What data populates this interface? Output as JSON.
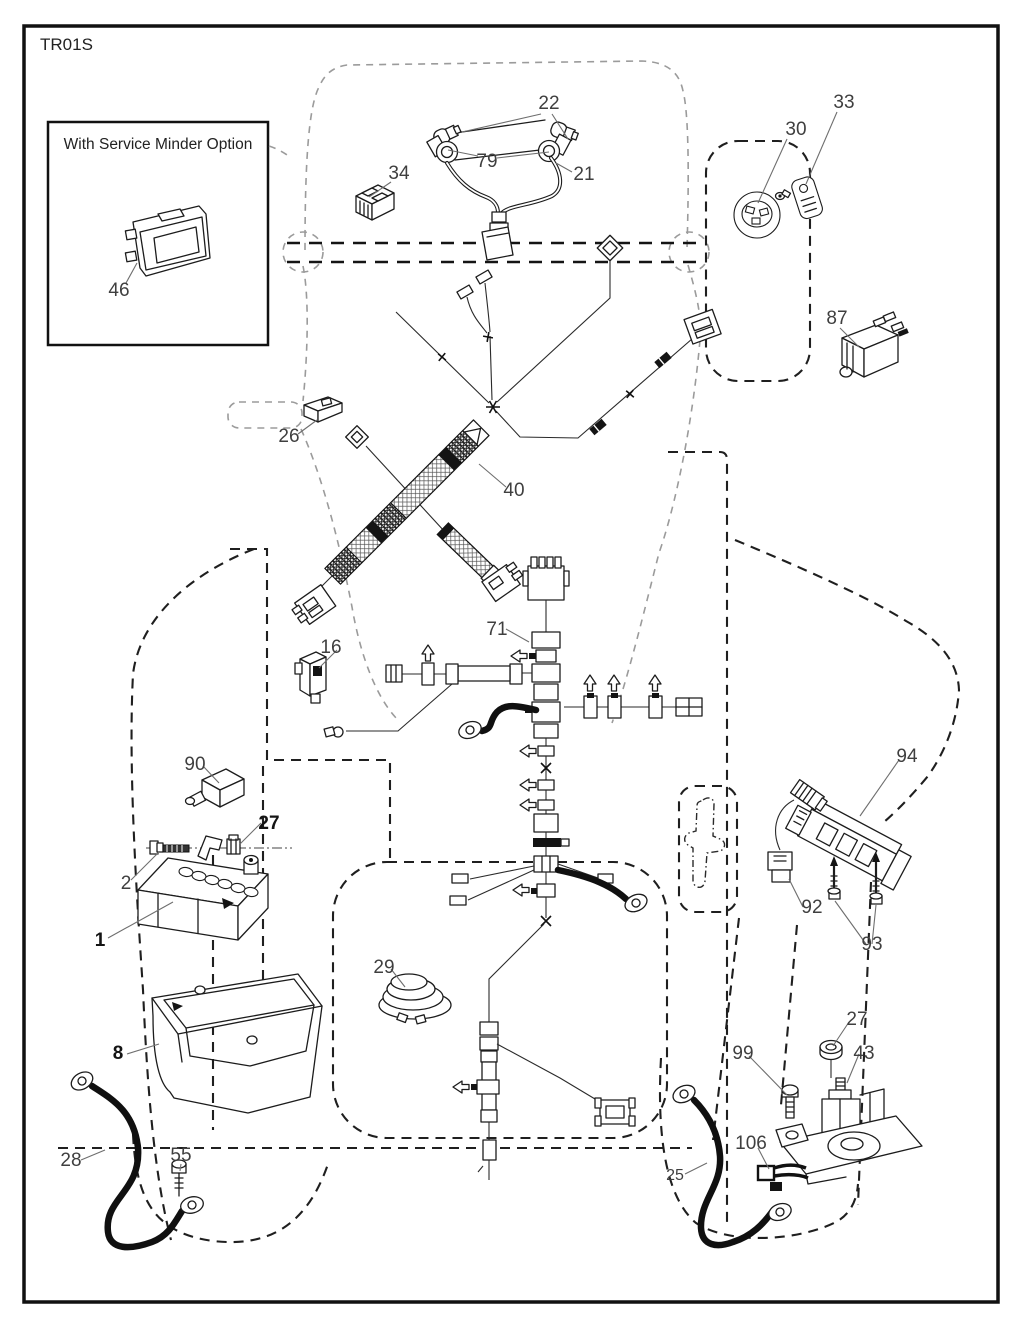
{
  "diagram": {
    "title": "TR01S",
    "inset_title": "With Service Minder Option",
    "labels": [
      {
        "part": "22",
        "text": "22"
      },
      {
        "part": "79",
        "text": "79"
      },
      {
        "part": "21",
        "text": "21"
      },
      {
        "part": "34",
        "text": "34"
      },
      {
        "part": "30",
        "text": "30"
      },
      {
        "part": "33",
        "text": "33"
      },
      {
        "part": "87",
        "text": "87"
      },
      {
        "part": "26",
        "text": "26"
      },
      {
        "part": "40",
        "text": "40"
      },
      {
        "part": "71",
        "text": "71"
      },
      {
        "part": "16",
        "text": "16"
      },
      {
        "part": "90",
        "text": "90"
      },
      {
        "part": "27-battery",
        "text": "27"
      },
      {
        "part": "2",
        "text": "2"
      },
      {
        "part": "1",
        "text": "1"
      },
      {
        "part": "8",
        "text": "8"
      },
      {
        "part": "29",
        "text": "29"
      },
      {
        "part": "28",
        "text": "28"
      },
      {
        "part": "55",
        "text": "55"
      },
      {
        "part": "94",
        "text": "94"
      },
      {
        "part": "92",
        "text": "92"
      },
      {
        "part": "93",
        "text": "93"
      },
      {
        "part": "27-solenoid",
        "text": "27"
      },
      {
        "part": "43",
        "text": "43"
      },
      {
        "part": "99",
        "text": "99"
      },
      {
        "part": "106",
        "text": "106"
      },
      {
        "part": "25",
        "text": "25"
      },
      {
        "part": "46",
        "text": "46"
      }
    ]
  }
}
